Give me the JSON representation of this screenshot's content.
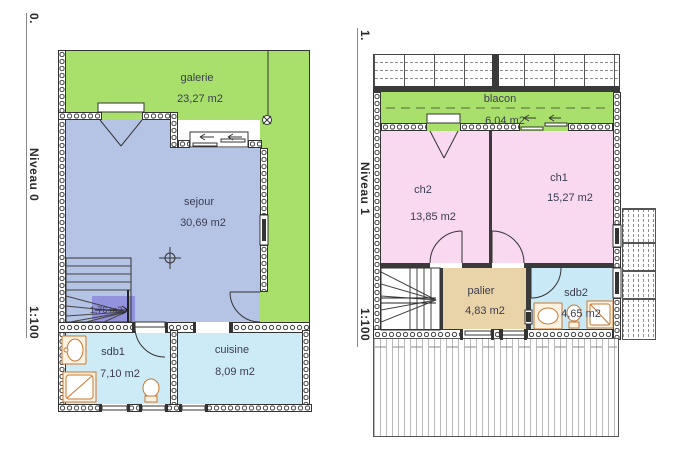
{
  "drawing": {
    "type": "floor-plans",
    "sheet_background": "#ffffff"
  },
  "levels": [
    {
      "marker": "0.",
      "name": "Niveau 0",
      "scale": "1:100",
      "rooms": [
        {
          "id": "galerie",
          "label": "galerie",
          "area": "23,27 m2"
        },
        {
          "id": "sejour",
          "label": "sejour",
          "area": "30,69 m2"
        },
        {
          "id": "hall",
          "label": "",
          "area": "1,76 m2"
        },
        {
          "id": "sdb1",
          "label": "sdb1",
          "area": "7,10 m2"
        },
        {
          "id": "cuisine",
          "label": "cuisine",
          "area": "8,09 m2"
        }
      ]
    },
    {
      "marker": "1.",
      "name": "Niveau 1",
      "scale": "1:100",
      "rooms": [
        {
          "id": "blacon",
          "label": "blacon",
          "area": "6,04 m2"
        },
        {
          "id": "ch2",
          "label": "ch2",
          "area": "13,85 m2"
        },
        {
          "id": "ch1",
          "label": "ch1",
          "area": "15,27 m2"
        },
        {
          "id": "palier",
          "label": "palier",
          "area": "4,83 m2"
        },
        {
          "id": "sdb2",
          "label": "sdb2",
          "area": "4,65 m2"
        }
      ]
    }
  ],
  "colors": {
    "galerie": "#a9e06c",
    "sejour": "#b5c4e5",
    "hall": "#9292dd",
    "wet_room": "#cdebf7",
    "bedroom": "#f8d9ef",
    "palier": "#e9d4a9",
    "sdb2": "#c9e9f6",
    "wall_line": "#333333",
    "fixture": "#c9772e",
    "label_text": "#3c3c52"
  }
}
